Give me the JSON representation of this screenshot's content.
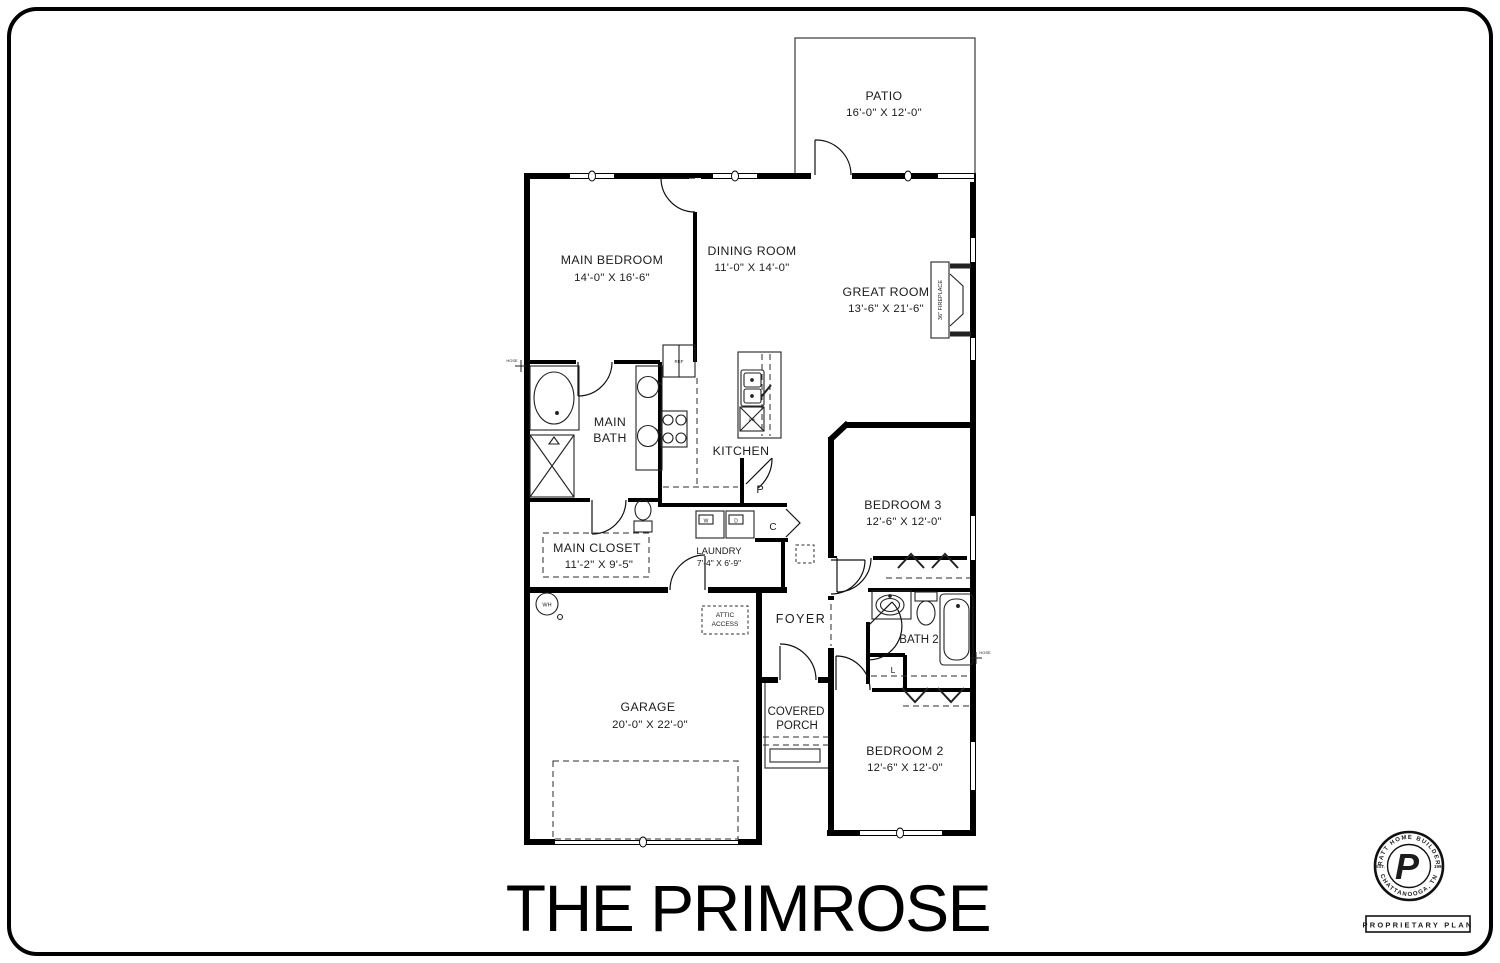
{
  "title": "THE PRIMROSE",
  "rooms": {
    "patio": {
      "name": "PATIO",
      "dims": "16'-0\" X 12'-0\""
    },
    "main_bedroom": {
      "name": "MAIN BEDROOM",
      "dims": "14'-0\" X 16'-6\""
    },
    "dining": {
      "name": "DINING ROOM",
      "dims": "11'-0\" X 14'-0\""
    },
    "great_room": {
      "name": "GREAT ROOM",
      "dims": "13'-6\" X 21'-6\""
    },
    "main_bath": {
      "line1": "MAIN",
      "line2": "BATH"
    },
    "kitchen": {
      "name": "KITCHEN"
    },
    "main_closet": {
      "name": "MAIN CLOSET",
      "dims": "11'-2\" X 9'-5\""
    },
    "laundry": {
      "name": "LAUNDRY",
      "dims": "7'-4\" X 6'-9\""
    },
    "foyer": {
      "name": "FOYER"
    },
    "bedroom3": {
      "name": "BEDROOM 3",
      "dims": "12'-6\" X 12'-0\""
    },
    "bath2": {
      "name": "BATH 2"
    },
    "garage": {
      "name": "GARAGE",
      "dims": "20'-0\" X 22'-0\""
    },
    "covered_porch": {
      "line1": "COVERED",
      "line2": "PORCH"
    },
    "bedroom2": {
      "name": "BEDROOM 2",
      "dims": "12'-6\" X 12'-0\""
    }
  },
  "markers": {
    "attic_line1": "ATTIC",
    "attic_line2": "ACCESS",
    "fireplace": "36\" FIREPLACE",
    "washer": "W",
    "dryer": "D",
    "water_heater": "WH",
    "pantry": "P",
    "closet": "C",
    "linen": "L",
    "dishwasher": "DW",
    "fridge": "REF",
    "hose": "HOSE"
  },
  "logo": {
    "arc_top": "PRATT HOME BUILDERS",
    "arc_bottom": "CHATTANOOGA, TN",
    "est": "EST.",
    "year": "1996",
    "monogram": "P",
    "banner": "PROPRIETARY PLAN"
  },
  "colors": {
    "wall": "#000000",
    "line": "#2b2b2b",
    "background": "#ffffff"
  }
}
